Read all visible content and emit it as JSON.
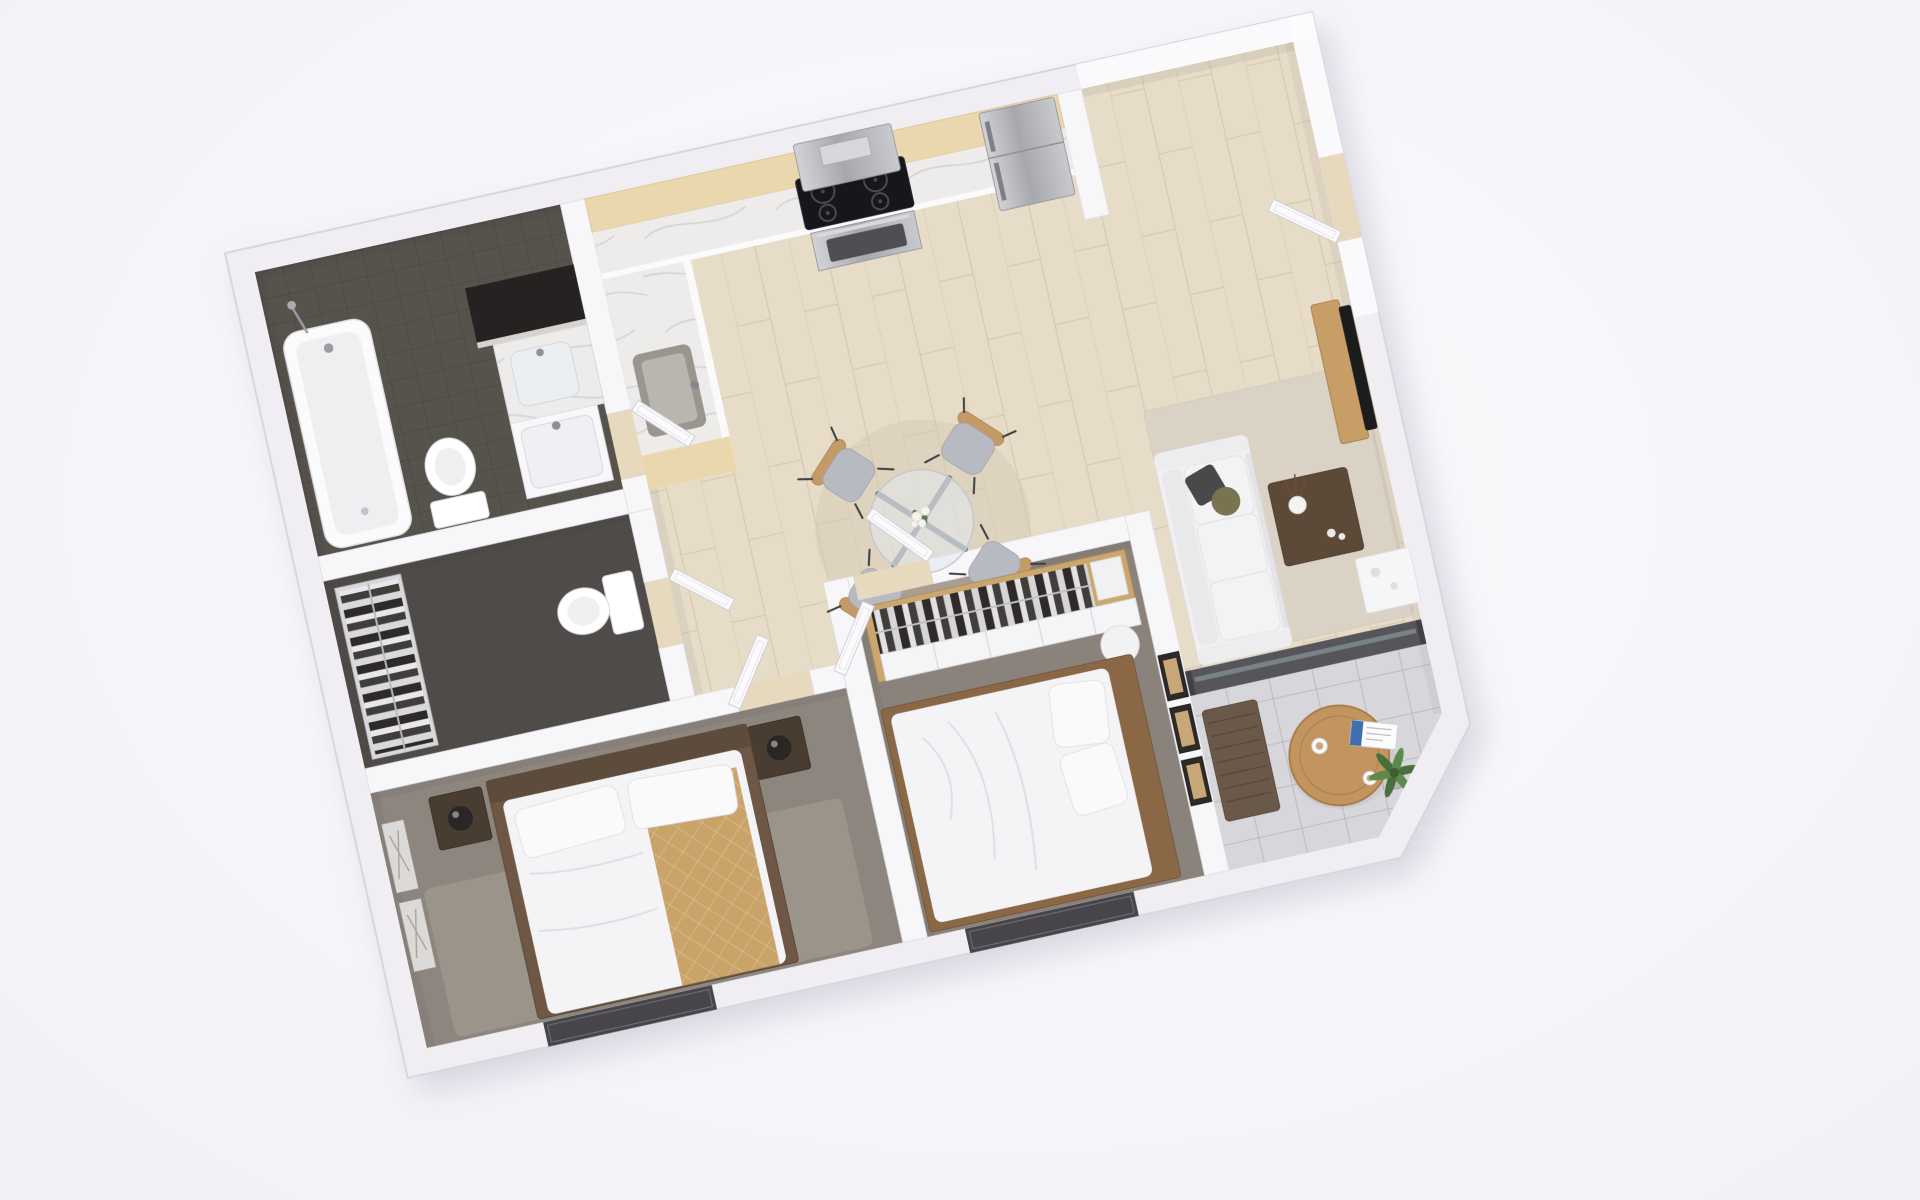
{
  "scene": {
    "type": "3d-floor-plan-render",
    "view": "isometric top-down dollhouse",
    "rotation_deg": -12.5,
    "description": "Rendered 3D floor plan of a two-bedroom apartment with bathroom, WC closet, kitchen-dining area, living room and balcony"
  },
  "palette": {
    "background": "#f6f5f9",
    "wall": "#f0eef3",
    "wall_edge": "#d8d5dc",
    "interior_wall": "#f7f6f8",
    "wood_floor": "#e6dcc8",
    "counter_wood": "#ead7ae",
    "marble": "#edecea",
    "cooktop": "#17181a",
    "steel": "#b4b6ba",
    "bath_tile": "#57524e",
    "wc_floor": "#4f4b48",
    "carpet_bed1": "#8d867e",
    "carpet_bed2": "#8a837b",
    "rug_living": "#dbd2c6",
    "rug_bed1": "#9b948a",
    "rug_dining": "#d6cab4",
    "sofa": "#f1f1f3",
    "pillow_dark": "#4a4a4c",
    "pillow_olive": "#7a7350",
    "coffee_table": "#5d4a39",
    "side_table_white": "#f6f6f8",
    "tv": "#1c1b1d",
    "tv_console": "#c79e66",
    "bed_linen": "#f4f4f6",
    "throw_tan": "#c9a368",
    "bed_frame": "#6e5844",
    "headboard_bed2": "#8a6844",
    "wardrobe_wood": "#cba76f",
    "clothes_dark": "#2e2b29",
    "glass_partition": "#55555a",
    "balcony_floor": "#d7d6da",
    "balcony_table": "#c2955e",
    "bench": "#6a5948",
    "plant": "#4c7440",
    "door": "#fbfbfd",
    "window_dark": "#46454a"
  },
  "rooms": [
    {
      "id": "bathroom",
      "label": "Bathroom",
      "floor": "dark gray tile",
      "furniture": [
        "bathtub",
        "handheld-shower",
        "toilet",
        "mirror",
        "vessel-sink-counter",
        "sink-cabinet"
      ]
    },
    {
      "id": "wc-closet",
      "label": "WC / Closet",
      "floor": "dark carpet",
      "furniture": [
        "wire-shelving-with-clothes",
        "toilet"
      ]
    },
    {
      "id": "kitchen-dining",
      "label": "Kitchen & Dining",
      "floor": "light wood planks",
      "furniture": [
        "upper-wood-cabinets",
        "marble-worktop",
        "range-hood",
        "cooktop",
        "oven",
        "kitchen-sink",
        "refrigerator",
        "round-glass-dining-table",
        "flower-vase",
        "dining-chair x4",
        "round-rug"
      ]
    },
    {
      "id": "hallway",
      "label": "Hallway",
      "floor": "light wood planks",
      "furniture": [
        "open-door x5"
      ]
    },
    {
      "id": "living-room",
      "label": "Living Room",
      "floor": "light wood planks",
      "furniture": [
        "sofa",
        "throw-pillows",
        "beige-rug",
        "coffee-table",
        "vase-with-twigs",
        "white-side-table",
        "tv-console",
        "tv"
      ]
    },
    {
      "id": "bedroom-1",
      "label": "Bedroom 1",
      "floor": "gray carpet",
      "furniture": [
        "double-bed",
        "tan-quilted-runner",
        "nightstand x2",
        "lamp x2",
        "wall-art x2",
        "area-rug",
        "window"
      ]
    },
    {
      "id": "bedroom-2",
      "label": "Bedroom 2",
      "floor": "gray carpet",
      "furniture": [
        "wardrobe-with-hanging-clothes",
        "double-bed",
        "round-side-table",
        "wall-art x3",
        "window"
      ]
    },
    {
      "id": "balcony",
      "label": "Balcony",
      "floor": "stone pavers",
      "furniture": [
        "round-wood-table",
        "coffee-cup x2",
        "magazine",
        "wood-bench",
        "potted-plant"
      ]
    }
  ]
}
